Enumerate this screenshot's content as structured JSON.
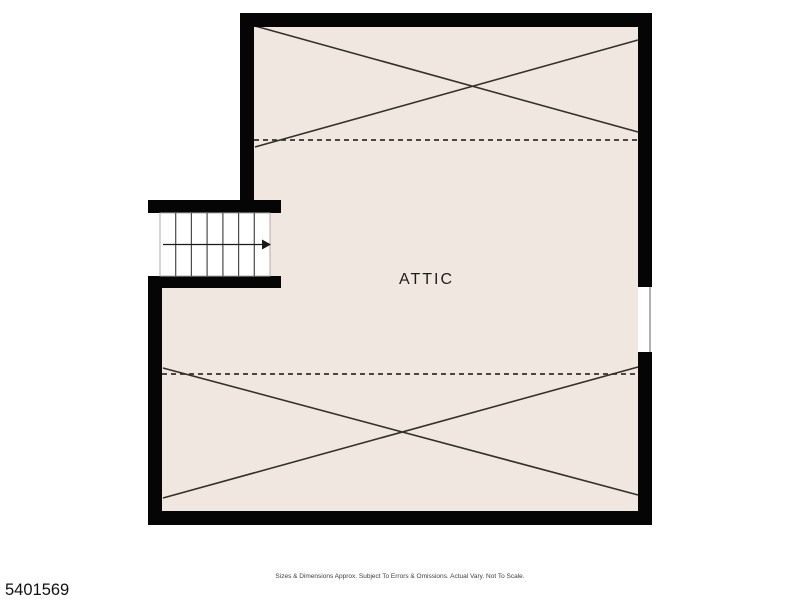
{
  "page": {
    "background": "#ffffff"
  },
  "floor_plan": {
    "room_label": "ATTIC",
    "stairs": {
      "treads": 7,
      "direction_arrow": "right"
    },
    "colors": {
      "wall": "#050505",
      "floor": "#f0e8e0",
      "stair_floor": "#ffffff",
      "line": "#35302b",
      "window_edge": "#999999"
    }
  },
  "footer": {
    "mls_number": "5401569",
    "disclaimer": "Sizes & Dimensions Approx. Subject To Errors & Omissions. Actual Vary. Not To Scale."
  }
}
